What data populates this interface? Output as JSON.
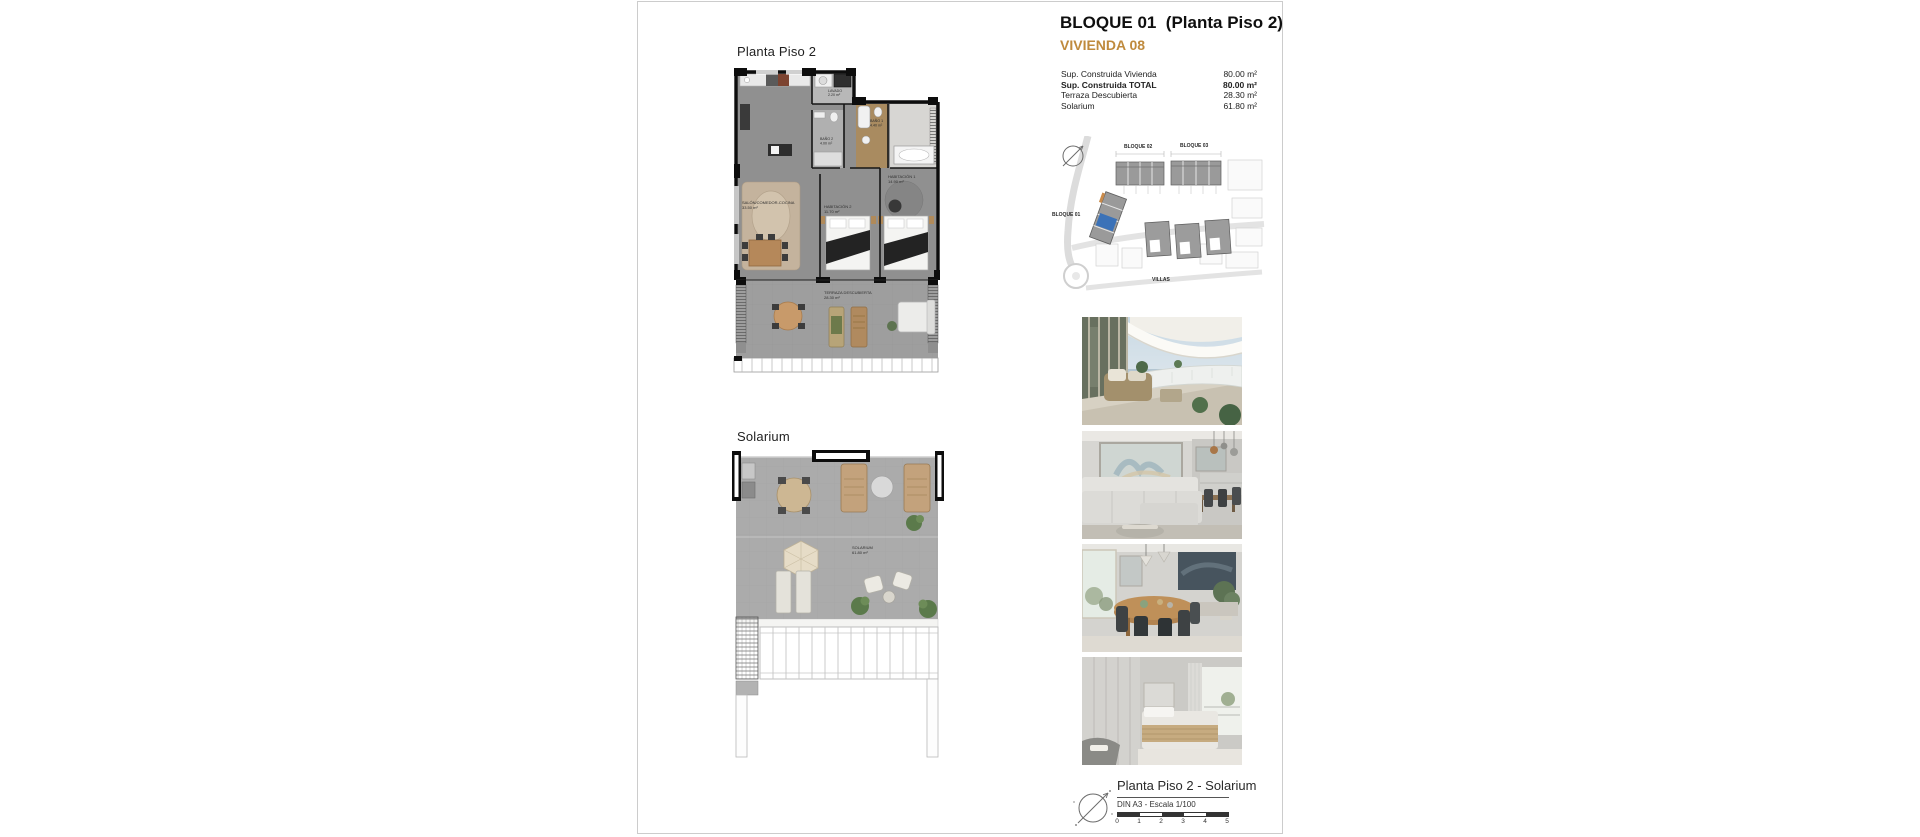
{
  "header": {
    "title": "BLOQUE 01  (Planta Piso 2)",
    "subtitle": "VIVIENDA 08"
  },
  "surfaces": {
    "rows": [
      {
        "label": "Sup. Construida Vivienda",
        "value": "80.00 m²"
      },
      {
        "label": "Sup. Construida TOTAL",
        "value": "80.00 m²"
      },
      {
        "label": "Terraza Descubierta",
        "value": "28.30 m²"
      },
      {
        "label": "Solarium",
        "value": "61.80 m²"
      }
    ]
  },
  "siteplan": {
    "bloque01": "BLOQUE 01",
    "bloque02": "BLOQUE 02",
    "bloque03": "BLOQUE 03",
    "villas": "VILLAS"
  },
  "plan_piso2": {
    "title": "Planta Piso 2",
    "rooms": {
      "salon": {
        "name": "SALÓN/COMEDOR-COCINA",
        "area": "33.50 m²"
      },
      "lavado": {
        "name": "LAVADO",
        "area": "2.20 m²"
      },
      "bano2": {
        "name": "BAÑO 2",
        "area": "4.00 m²"
      },
      "bano1": {
        "name": "BAÑO 1",
        "area": "4.40 m²"
      },
      "habitacion1": {
        "name": "HABITACIÓN 1",
        "area": "14.90 m²"
      },
      "habitacion2": {
        "name": "HABITACIÓN 2",
        "area": "11.70 m²"
      },
      "terraza": {
        "name": "TERRAZA DESCUBIERTA",
        "area": "28.30 m²"
      }
    }
  },
  "solarium": {
    "title": "Solarium",
    "room": {
      "name": "SOLARIUM",
      "area": "61.80 m²"
    }
  },
  "legend": {
    "title": "Planta Piso 2 - Solarium",
    "scale_note": "DIN A3 - Escala 1/100",
    "ticks": [
      "0",
      "1",
      "2",
      "3",
      "4",
      "5"
    ]
  },
  "colors": {
    "accent": "#bf8a3d",
    "highlight_unit": "#3b72b8"
  }
}
